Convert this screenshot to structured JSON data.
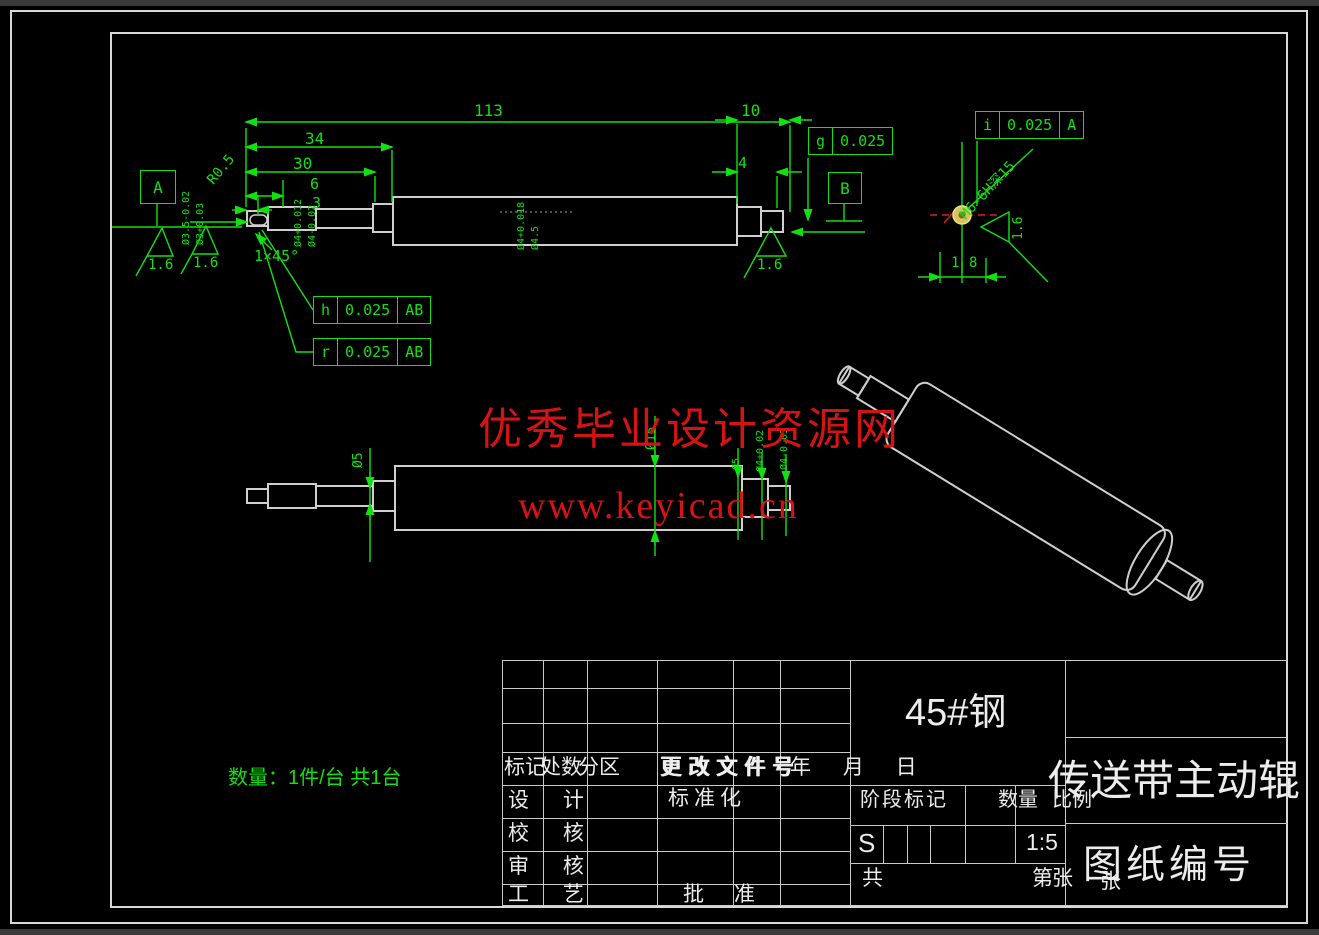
{
  "watermark": {
    "line1": "优秀毕业设计资源网",
    "line2": "www.keyicad.cn",
    "color": "#d41414"
  },
  "note": {
    "quantity": "数量：1件/台 共1台"
  },
  "datums": {
    "a": "A",
    "b": "B"
  },
  "fcf": {
    "g": {
      "sym": "g",
      "tol": "0.025"
    },
    "h": {
      "sym": "h",
      "tol": "0.025",
      "datum": "AB"
    },
    "r": {
      "sym": "r",
      "tol": "0.025",
      "datum": "AB"
    },
    "i": {
      "sym": "i",
      "tol": "0.025",
      "datum": "A"
    }
  },
  "dims": {
    "len113": "113",
    "len34": "34",
    "len30": "30",
    "len6": "6",
    "len3": "3",
    "len10": "10",
    "len4": "4",
    "radius": "R0.5",
    "chamfer": "1×45°",
    "rough": "1.6",
    "thread": "M6-6H深15",
    "d18_1": "1",
    "d18_2": "8",
    "dia_tv1": "Ø3.5-0.02",
    "dia_tv2": "Ø3+0.03",
    "dia_tv3": "Ø4+0.012",
    "dia_tv4": "Ø4-0.02",
    "dia_tv5": "Ø4+0.018",
    "dia_tv6": "Ø4.5",
    "dia_mv1": "Ø5",
    "dia_mv2": "Ø15",
    "dia_mv3": "Ø5",
    "dia_mv4": "Ø4+0.02",
    "dia_mv5": "Ø4-0.03"
  },
  "titleblock": {
    "mark": "标记",
    "count": "处数",
    "zone": "分区",
    "doc": "更改文件号",
    "date": "年 月 日",
    "design": "设 计",
    "standard": "标准化",
    "check": "校 核",
    "review": "审 核",
    "process": "工 艺",
    "approve": "批 准",
    "stage": "阶段标记",
    "qty": "数量",
    "scale_label": "比例",
    "s": "S",
    "scale": "1:5",
    "total": "共",
    "sheet": "第",
    "sheet_unit": "张",
    "sheet_unit2": "张",
    "material": "45#钢",
    "title": "传送带主动辊",
    "drawing_no": "图纸编号"
  },
  "colors": {
    "dimension_green": "#12e012",
    "outline_white": "#cfcfcf",
    "watermark_red": "#d41414",
    "hole_yellow": "#d8c15e"
  }
}
